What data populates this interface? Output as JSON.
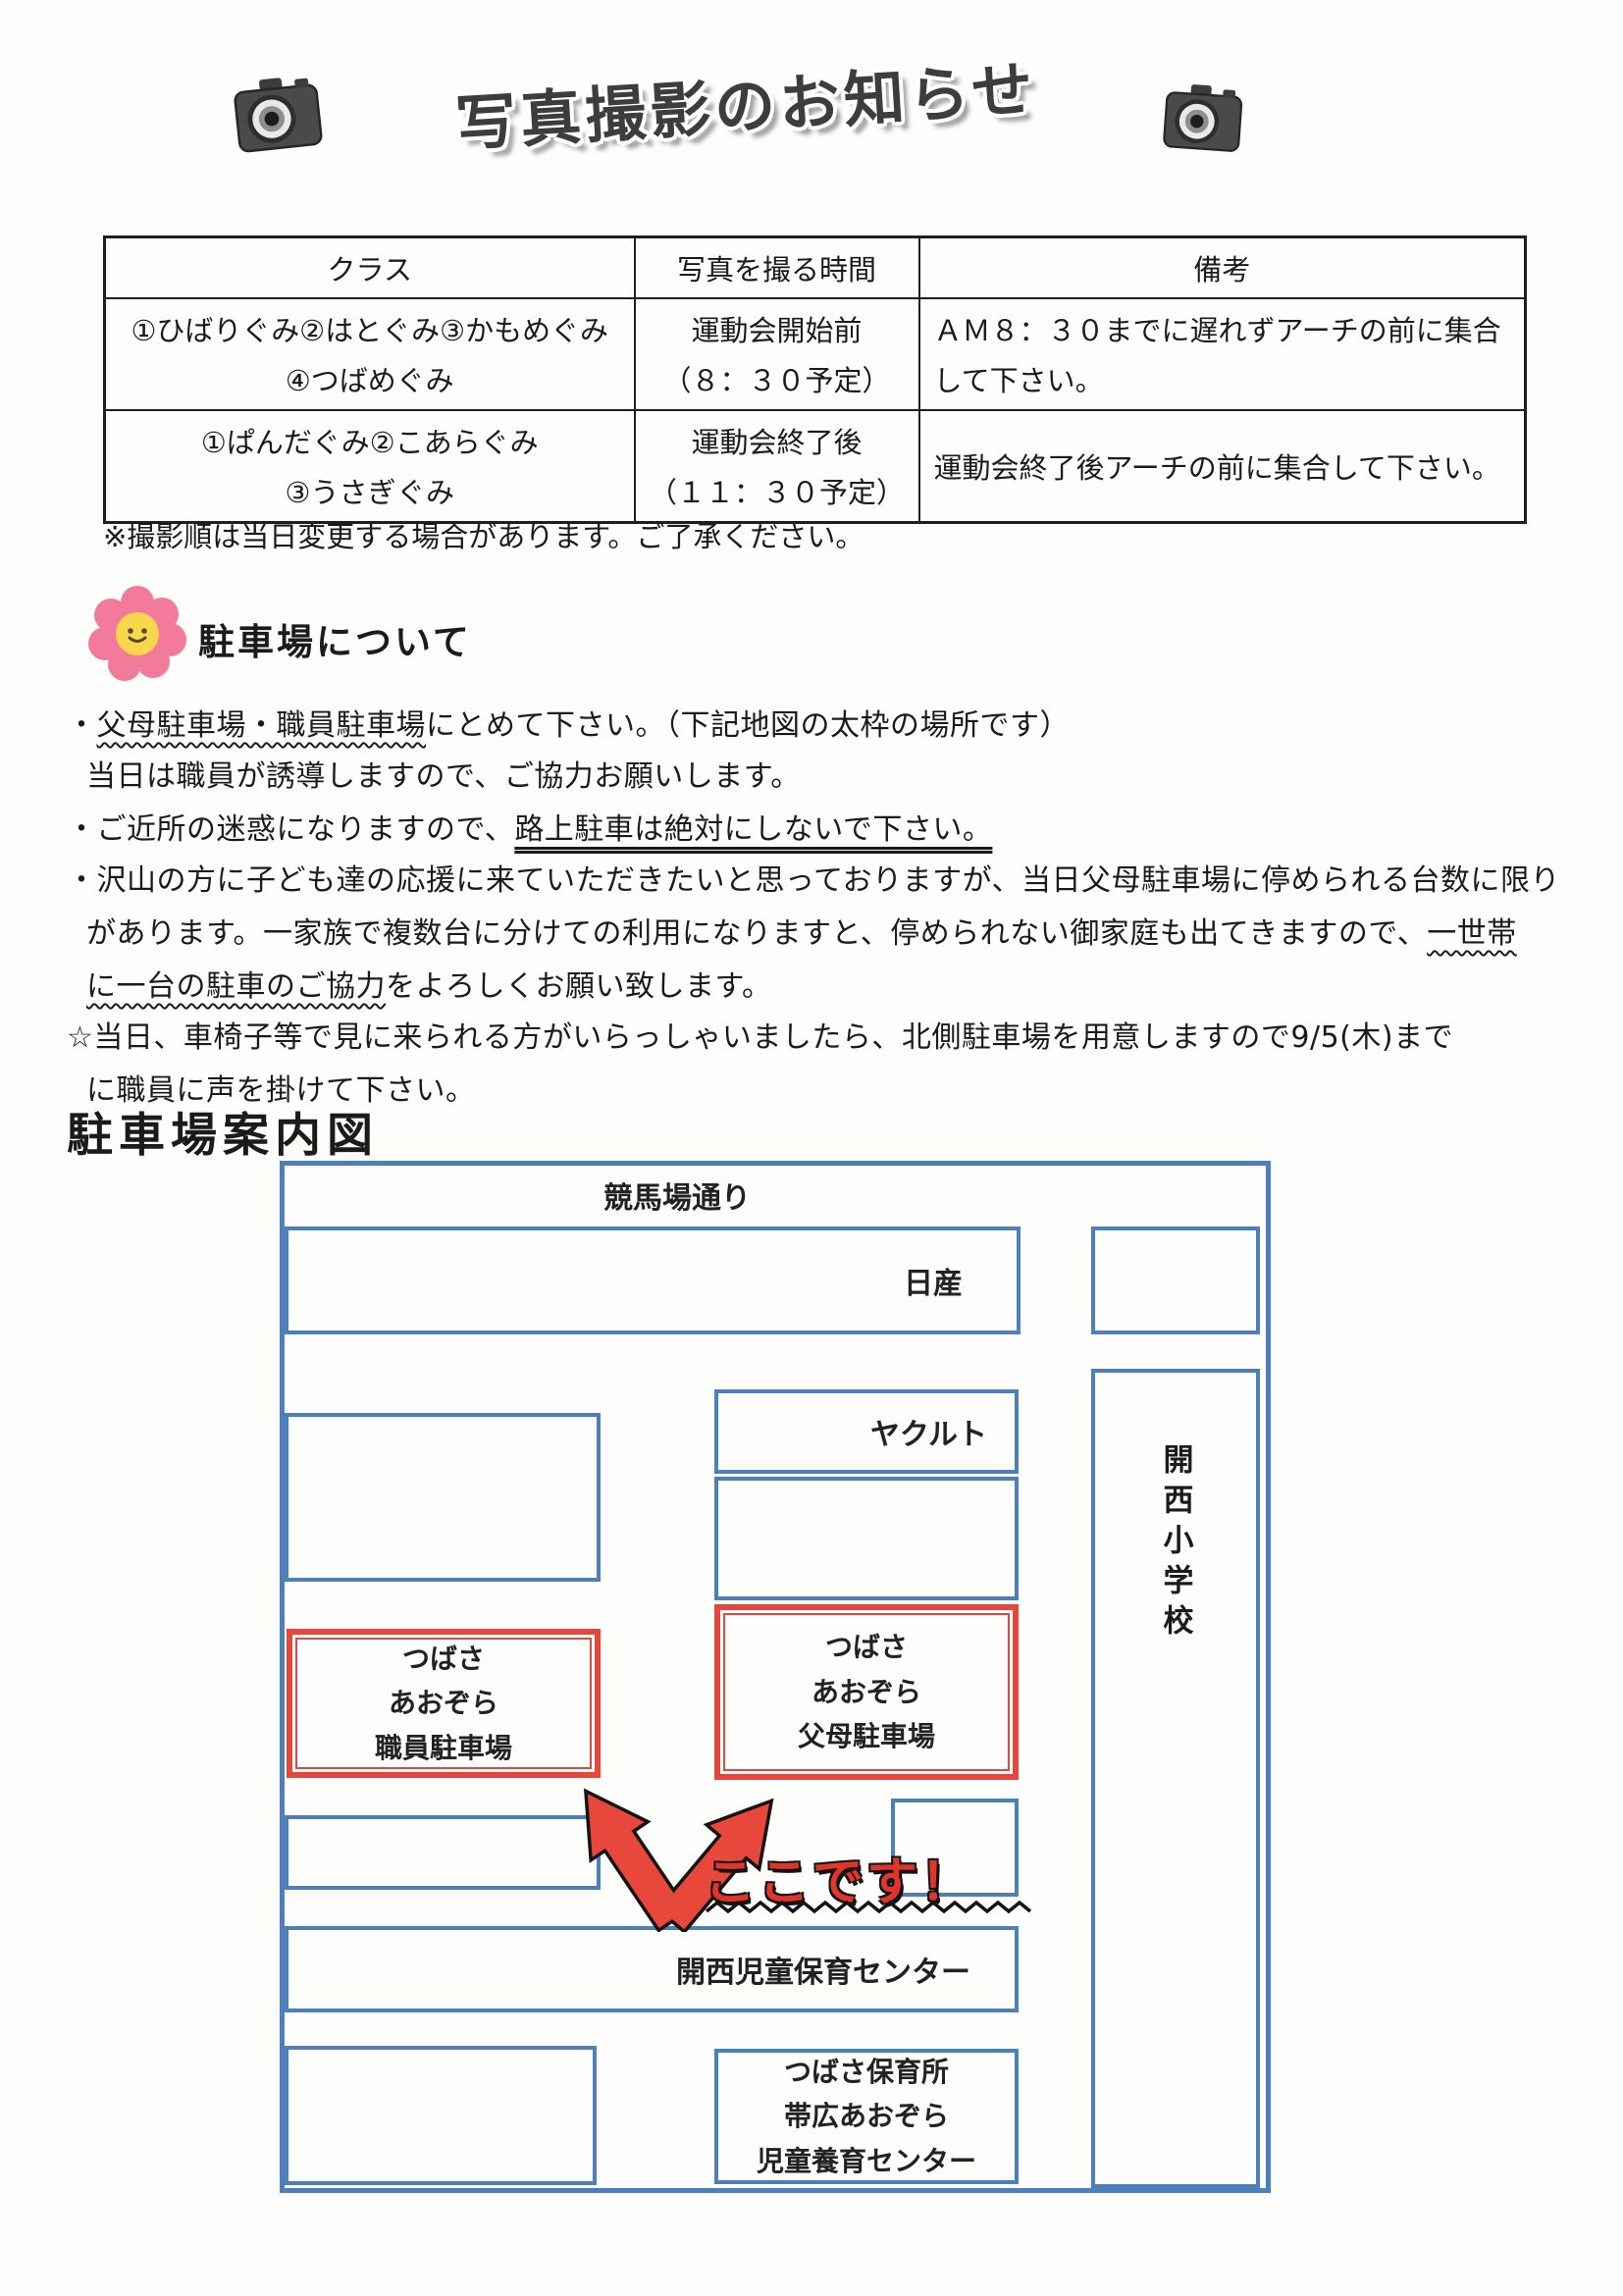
{
  "header": {
    "title": "写真撮影のお知らせ"
  },
  "table": {
    "headers": [
      "クラス",
      "写真を撮る時間",
      "備考"
    ],
    "rows": [
      {
        "class_line1": "①ひばりぐみ②はとぐみ③かもめぐみ",
        "class_line2": "④つばめぐみ",
        "time_line1": "運動会開始前",
        "time_line2": "（８：３０予定）",
        "note_line1": "ＡＭ８：３０までに遅れずアーチの前に集合",
        "note_line2": "して下さい。"
      },
      {
        "class_line1": "①ぱんだぐみ②こあらぐみ",
        "class_line2": "③うさぎぐみ",
        "time_line1": "運動会終了後",
        "time_line2": "（１１：３０予定）",
        "note_line1": "運動会終了後アーチの前に集合して下さい。"
      }
    ],
    "footnote": "※撮影順は当日変更する場合があります。ご了承ください。"
  },
  "parking": {
    "title": "駐車場について",
    "b1_pre": "・",
    "b1_u": "父母駐車場・職員駐車場",
    "b1_post": "にとめて下さい。（下記地図の太枠の場所です）",
    "b1_line2": "当日は職員が誘導しますので、ご協力お願いします。",
    "b2_pre": "・ご近所の迷惑になりますので、",
    "b2_u": "路上駐車は絶対にしないで下さい。",
    "b3_line1": "・沢山の方に子ども達の応援に来ていただきたいと思っておりますが、当日父母駐車場に停められる台数に限り",
    "b3_line2_pre": "があります。一家族で複数台に分けての利用になりますと、停められない御家庭も出てきますので、",
    "b3_line2_u": "一世帯",
    "b3_line3_u": "に一台の駐車のご協力",
    "b3_line3_post": "をよろしくお願い致します。",
    "b4_line1": "☆当日、車椅子等で見に来られる方がいらっしゃいましたら、北側駐車場を用意しますので9/5(木)まで",
    "b4_line2": "に職員に声を掛けて下さい。"
  },
  "map": {
    "title": "駐車場案内図",
    "road": "競馬場通り",
    "nissan": "日産",
    "yakult": "ヤクルト",
    "school": "開西小学校",
    "staff_lot": [
      "つばさ",
      "あおぞら",
      "職員駐車場"
    ],
    "parents_lot": [
      "つばさ",
      "あおぞら",
      "父母駐車場"
    ],
    "here": "ここです！",
    "childcare_center": "開西児童保育センター",
    "tsubasa": [
      "つばさ保育所",
      "帯広あおぞら",
      "児童養育センター"
    ]
  },
  "colors": {
    "map_blue": "#4d80ba",
    "lot_red": "#e8453c",
    "here_red": "#df352b"
  }
}
